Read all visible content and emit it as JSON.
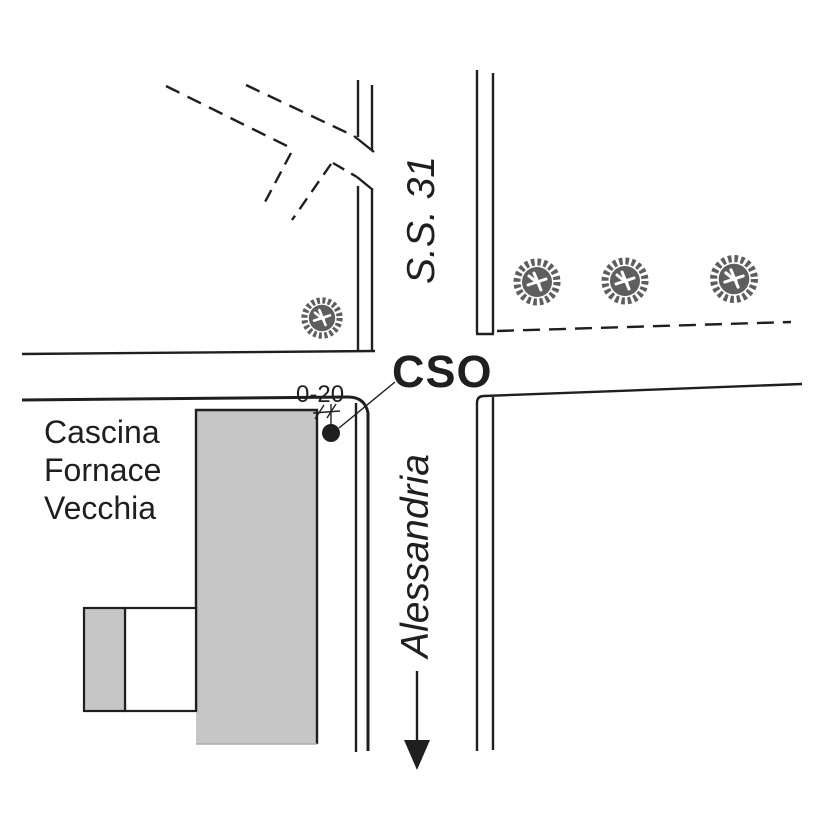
{
  "labels": {
    "route_north": "S.S. 31",
    "intersection": "CSO",
    "sample_point": "0-20",
    "direction_south": "Alessandria",
    "building": {
      "line1": "Cascina",
      "line2": "Fornace",
      "line3": "Vecchia"
    }
  },
  "icons": {
    "tree": "tree-icon",
    "direction_arrow": "arrow-down-icon",
    "sample_marker": "filled-circle-icon"
  },
  "colors": {
    "line": "#1f1f1f",
    "building_fill": "#c6c6c6",
    "tree_fill": "#5e5e5e",
    "background": "#ffffff"
  },
  "features": {
    "trees_count": 4,
    "sample_points_count": 1
  }
}
